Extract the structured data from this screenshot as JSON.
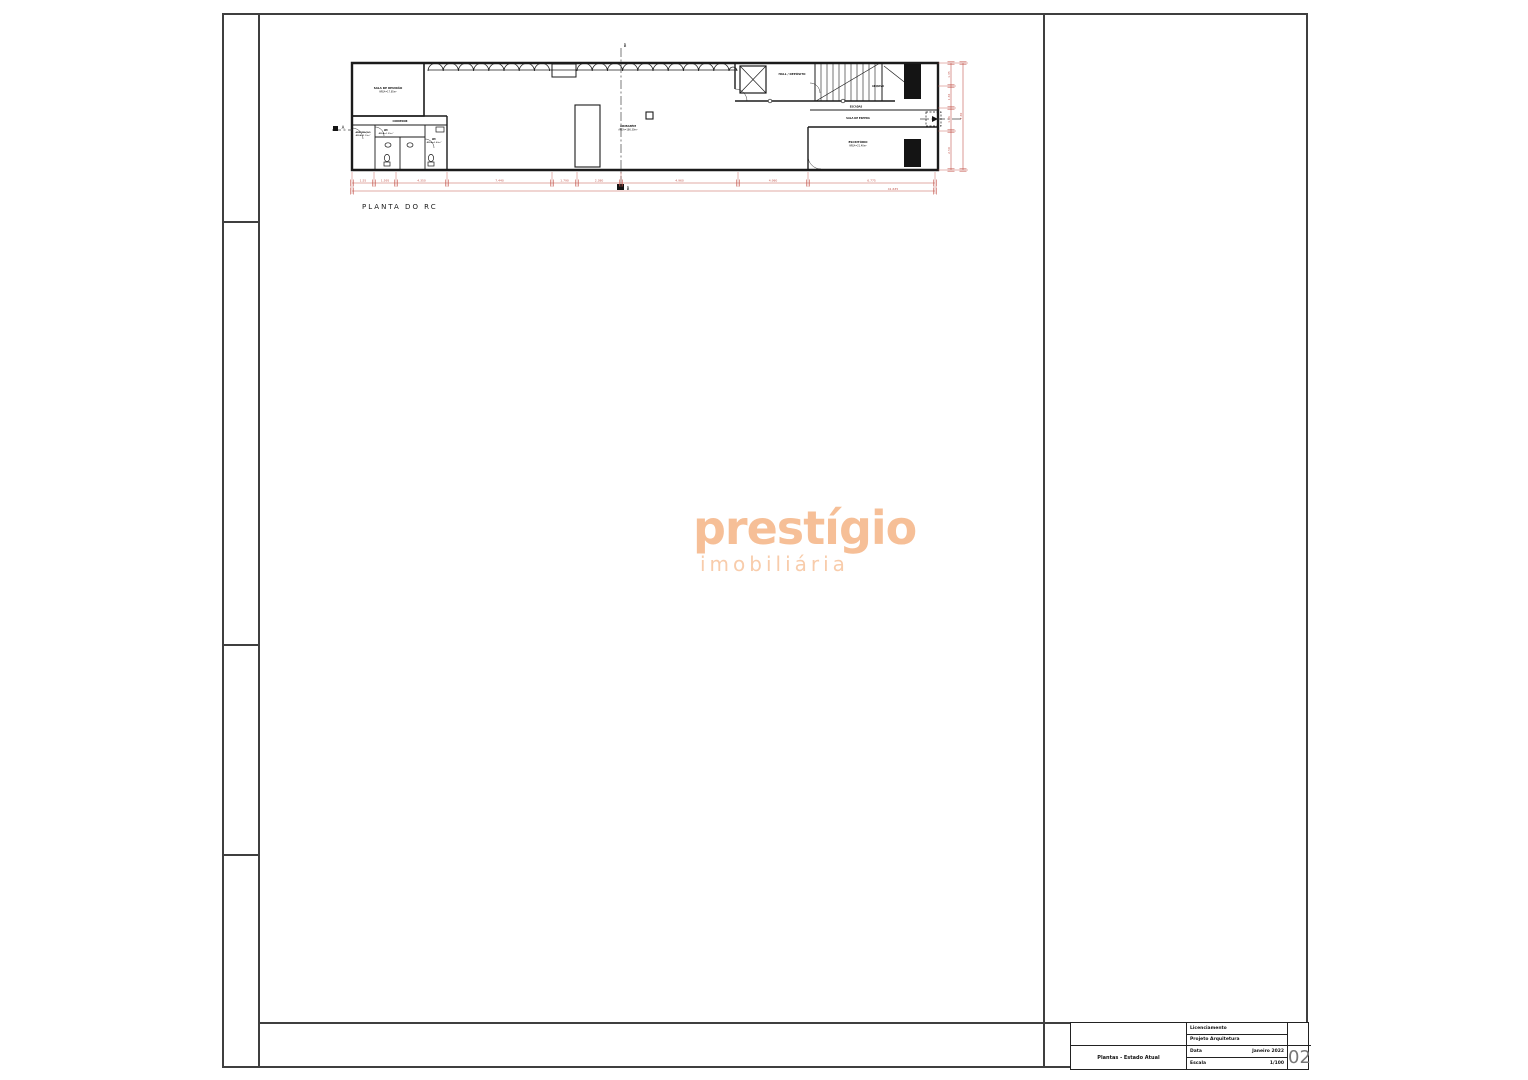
{
  "sheet": {
    "caption": "PLANTA DO RC",
    "section_b": "B",
    "section_a": "A"
  },
  "watermark": {
    "line1": "prestígio",
    "line2": "imobiliária",
    "color_primary": "#f6bf97",
    "color_secondary": "#f8ccab"
  },
  "plan": {
    "labels": {
      "sala_reuniao_1": "SALA DE REUNIÃO",
      "sala_reuniao_2": "ÁREA=17.85m²",
      "corredor": "CORREDOR",
      "arrumacao_1": "ARRUMAÇÃO",
      "arrumacao_2": "ÁREA=2.10m²",
      "wc1_1": "WC",
      "wc1_2": "ÁREA=1.95m²",
      "wc2_1": "WC",
      "wc2_2": "ÁREA=2.40m²",
      "armazem_1": "ARMAZÉM",
      "armazem_2": "ÁREA=186.30m²",
      "hall": "HALL / DEPÓSITO",
      "arquivo": "ARQUIVO",
      "escadas": "ESCADAS",
      "sala_espera": "SALA DE ESPERA",
      "escritorio_1": "ESCRITÓRIO",
      "escritorio_2": "ÁREA=21.40m²"
    },
    "dims_bottom": [
      "1.55",
      "1.595",
      "4.350",
      "7.440",
      "1.790",
      "2.380",
      "4.960",
      "4.980",
      "6.775"
    ],
    "dims_bottom_total": "41.635",
    "dims_right": [
      "1.35",
      "1.36",
      "1.36",
      "2.50"
    ],
    "dims_right_total": "7.30",
    "dim_color": "#c4584f"
  },
  "titleblock": {
    "row1": "Licenciamento",
    "row2": "Projeto Arquitetura",
    "data_label": "Data",
    "data_value": "Janeiro 2022",
    "escala_label": "Escala",
    "escala_value": "1/100",
    "drawing_title": "Plantas  -  Estado Atual",
    "sheet_number": "02"
  }
}
